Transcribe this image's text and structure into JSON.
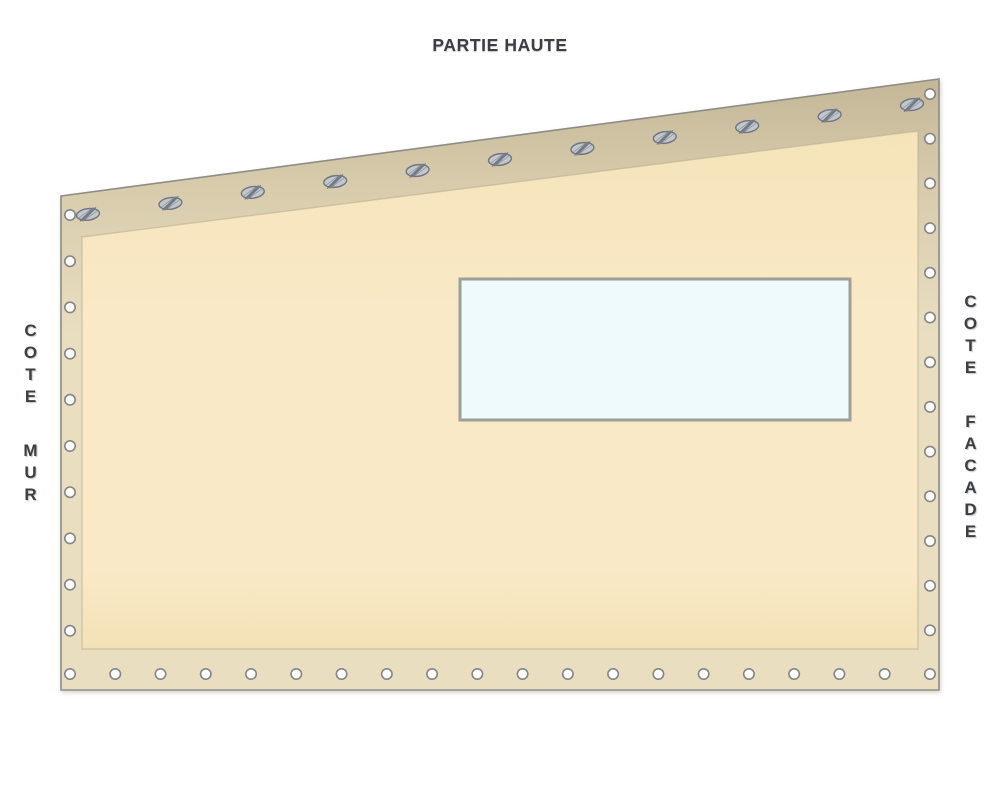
{
  "diagram": {
    "labels": {
      "top": "PARTIE HAUTE",
      "bottom": "PARTIE BASSE",
      "left": "COTE MUR",
      "right": "COTE FACADE"
    },
    "colors": {
      "band_dark": "#c3b798",
      "band_mid": "#d8ccad",
      "band": "#e9dec0",
      "panel_top": "#f5e3b9",
      "panel": "#f9e9c6",
      "panel_bottom": "#f3e1b6",
      "outline": "#8d8d86",
      "panel_outline": "#b9ad8e",
      "window_fill": "#eefafc",
      "window_border": "#9f9f99",
      "eyelet_fill": "#ffffff",
      "eyelet_stroke": "#858585",
      "grommet_fill": "#c2c7ce",
      "grommet_stroke": "#70767f",
      "grommet_bar": "#7c828c"
    },
    "eyelets": {
      "left": {
        "x": 70,
        "y_start": 215,
        "spacing": 46.2,
        "count": 10
      },
      "right": {
        "x": 930,
        "y_start": 94,
        "spacing": 44.7,
        "count": 13
      },
      "bottom": {
        "y": 674,
        "x_start": 70,
        "spacing": 45.26,
        "count": 20
      },
      "top_grommets": {
        "x_start": 88,
        "y_start": 214.4,
        "x_end": 912,
        "y_end": 104.6,
        "count": 11,
        "angle_deg": -7.6
      }
    }
  }
}
